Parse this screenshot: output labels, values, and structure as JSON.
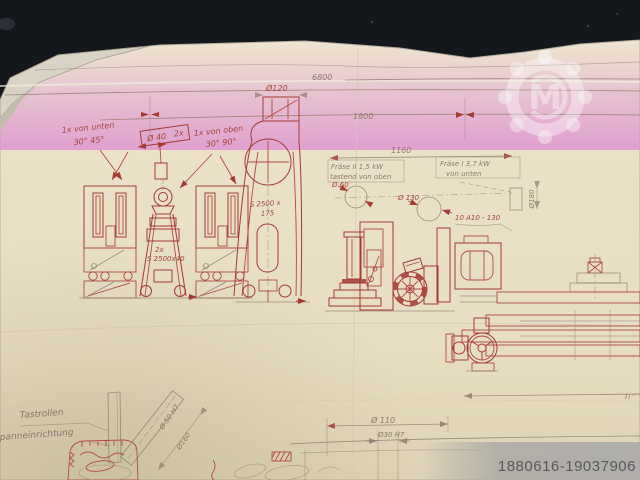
{
  "photo": {
    "listing_id": "1880616-19037906"
  },
  "watermark": {
    "letter": "M"
  },
  "notes": {
    "von_unten_line1": "1x von unten",
    "von_unten_line2": "30° 45°",
    "von_oben_line1": "1x von oben",
    "von_oben_line2": "30° 90°",
    "spindle_dia": "Ø 40",
    "spindle_qty": "2x",
    "fraese2_line1": "Fräse II  1,5 kW",
    "fraese2_line2": "tastend von oben",
    "fraese1_line1": "Fräse I  3,7 kW",
    "fraese1_line2": "von unten",
    "tool_spec": "10 A10 - 130",
    "tastrollen": "Tastrollen",
    "spanneinrichtung": "panneinrichtung",
    "corner_fragment": "Ti"
  },
  "dimensions": {
    "overall_length": "6800",
    "section_length": "1800",
    "unit_spacing": "1160",
    "dia_120": "Ø120",
    "belt_large_line1": "S 2500 x",
    "belt_large_line2": "175",
    "belt_small_line1": "2x",
    "belt_small_line2": "S 2500x40",
    "dia_60": "Ø 60",
    "dia_130": "Ø 130",
    "dia_180": "Ø180",
    "dia_50h7": "Ø 50 H7",
    "dia_160": "Ø160",
    "dia_110": "Ø 110",
    "dia_30h7": "Ø30 H7"
  },
  "colors": {
    "background": "#14171c",
    "paper": "#e9e0c6",
    "ink_red": "#a33b33",
    "pencil": "#8d7e6e",
    "id_text": "#57575a"
  }
}
